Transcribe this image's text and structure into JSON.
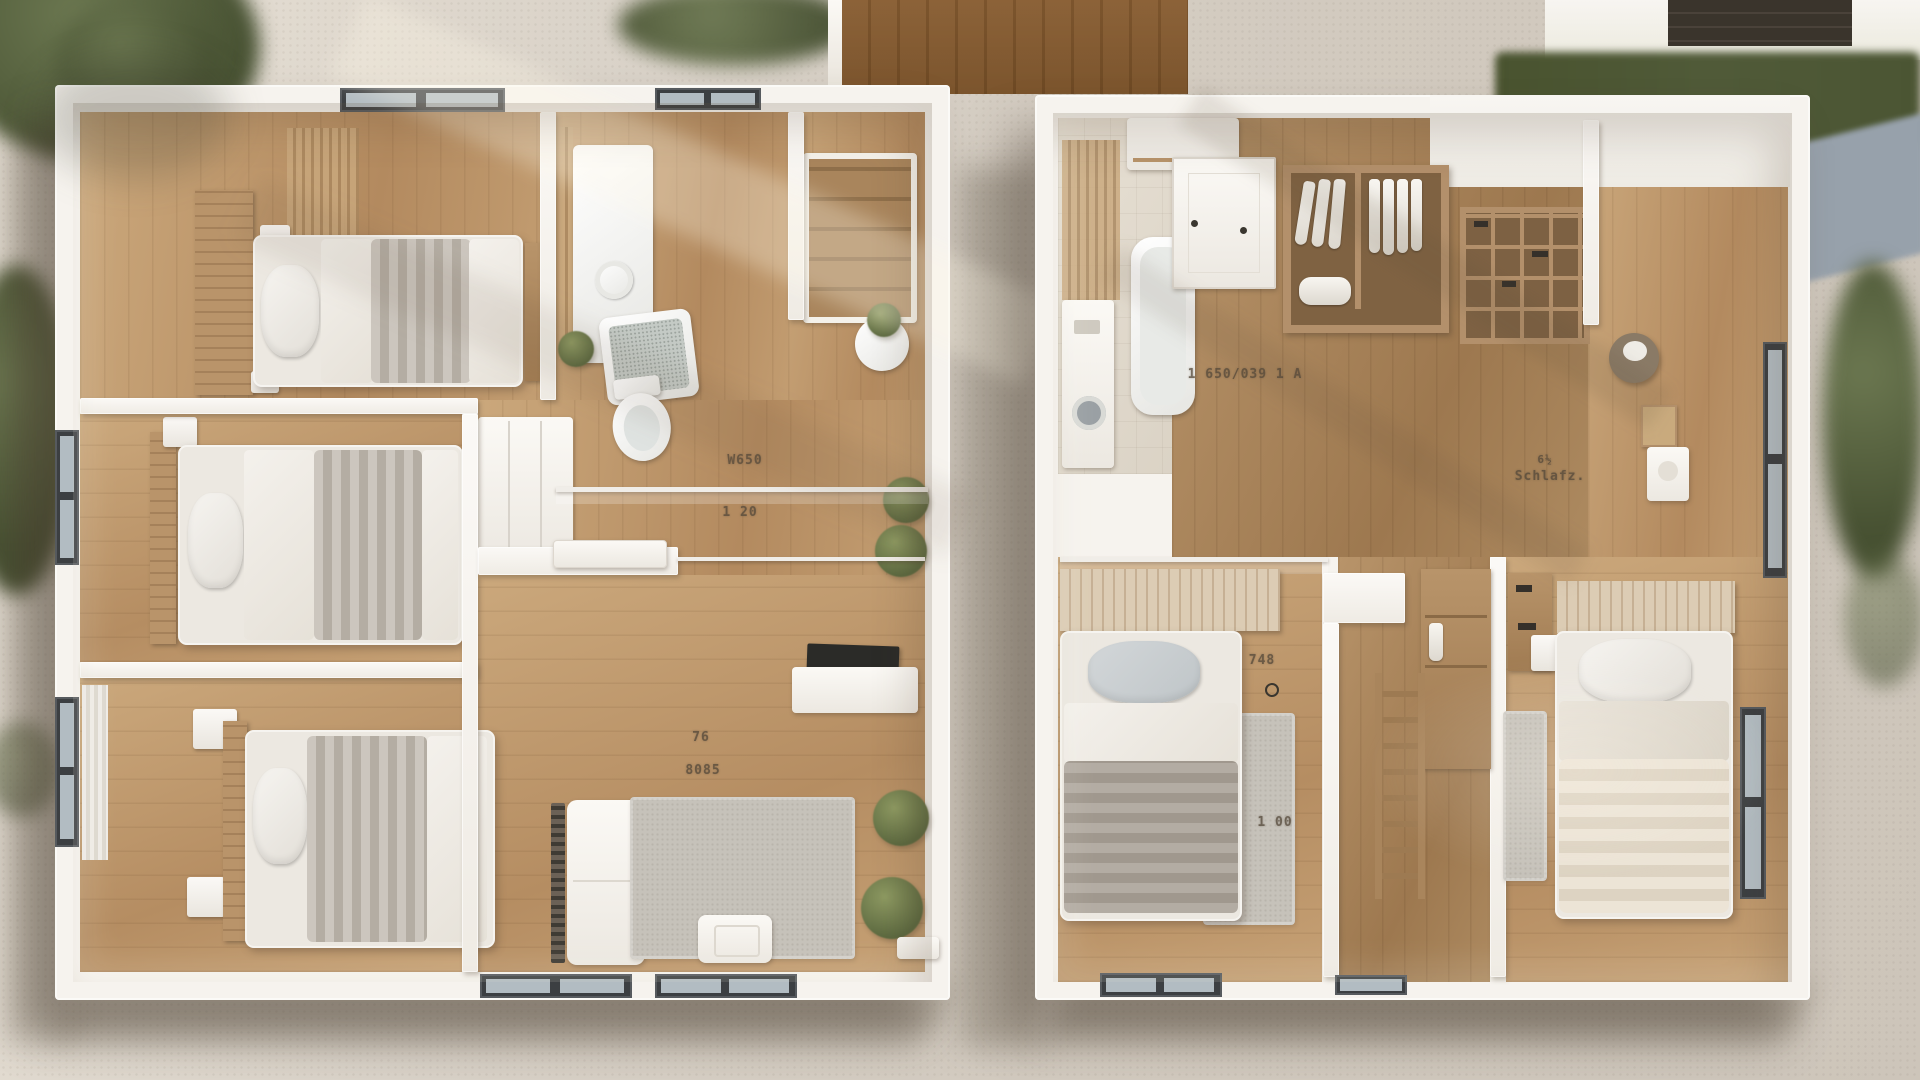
{
  "scene": {
    "description": "Aerial 3D dollhouse render of two furnished apartment floor plans side by side, surrounded by gravel paths, hedges and trees",
    "left_unit_rooms": [
      "bedroom-top",
      "bedroom-middle",
      "bedroom-bottom",
      "bathroom",
      "hallway",
      "living-room"
    ],
    "right_unit_rooms": [
      "bathroom-laundry",
      "entry-hall",
      "dressing-area",
      "closet-room",
      "hallway",
      "bedroom-left",
      "bedroom-right"
    ]
  },
  "palette": {
    "gravel": "#d6cfc5",
    "wall_white": "#f6f3ee",
    "floor_wood": "#c5a074",
    "floor_wood_dark": "#a8825a",
    "grass_dark": "#515c3b",
    "path_blue_gray": "#97a1ab",
    "boardwalk_wood": "#b3966e",
    "rug_gray": "#c6c2ba",
    "duvet_gray": "#a9a199",
    "duvet_cream": "#e8e0d2",
    "furniture_wood": "#b08a5f",
    "window_frame": "#3c3f42",
    "label_ink": "#55493a"
  },
  "labels": {
    "left": {
      "hall_line1": "W650",
      "hall_line2": "1 20",
      "living_line1": "76",
      "living_line2": "8085"
    },
    "right": {
      "hall": "1 650/039 1 A",
      "closet_line1": "6½",
      "closet_line2": "Schlafz.",
      "bedroom_line1": "748",
      "bedroom_line2": "1 00"
    }
  }
}
